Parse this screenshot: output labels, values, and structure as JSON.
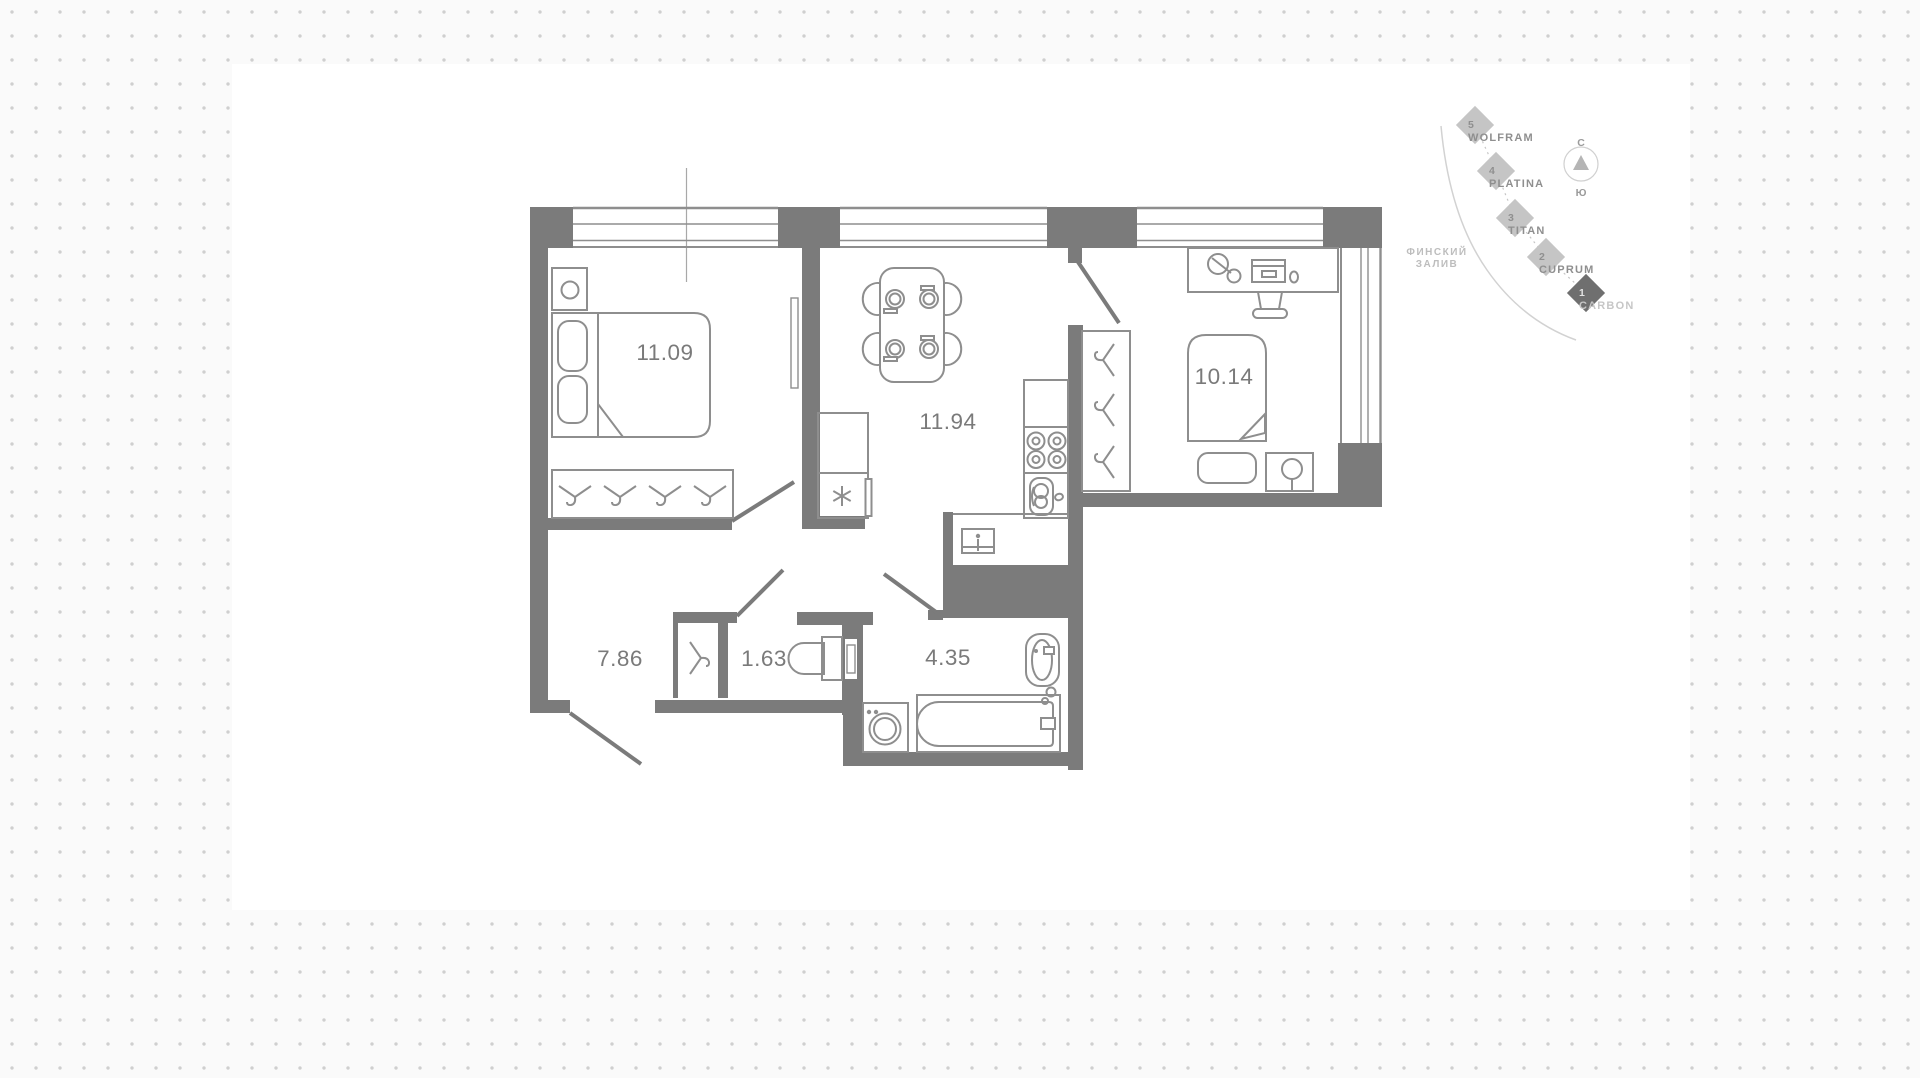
{
  "plan": {
    "rooms": [
      {
        "name": "bedroom-1",
        "area": "11.09"
      },
      {
        "name": "kitchen-living",
        "area": "11.94"
      },
      {
        "name": "bedroom-2",
        "area": "10.14"
      },
      {
        "name": "hallway",
        "area": "7.86"
      },
      {
        "name": "closet",
        "area": "1.63"
      },
      {
        "name": "bathroom",
        "area": "4.35"
      }
    ]
  },
  "minimap": {
    "buildings": [
      {
        "number": "5",
        "name": "WOLFRAM",
        "active": false
      },
      {
        "number": "4",
        "name": "PLATINA",
        "active": false
      },
      {
        "number": "3",
        "name": "TITAN",
        "active": false
      },
      {
        "number": "2",
        "name": "CUPRUM",
        "active": false
      },
      {
        "number": "1",
        "name": "CARBON",
        "active": true
      }
    ],
    "compass": {
      "north": "С",
      "south": "Ю"
    },
    "water": {
      "line1": "ФИНСКИЙ",
      "line2": "ЗАЛИВ"
    }
  },
  "colors": {
    "wall": "#7b7b7b",
    "furniture_line": "#8e8e8e",
    "label": "#7a7a7a",
    "diamond": "#c5c5c5",
    "diamond_active": "#6f6f6f",
    "background": "#fafafa",
    "card": "#ffffff",
    "dot": "#cfcfcf"
  }
}
